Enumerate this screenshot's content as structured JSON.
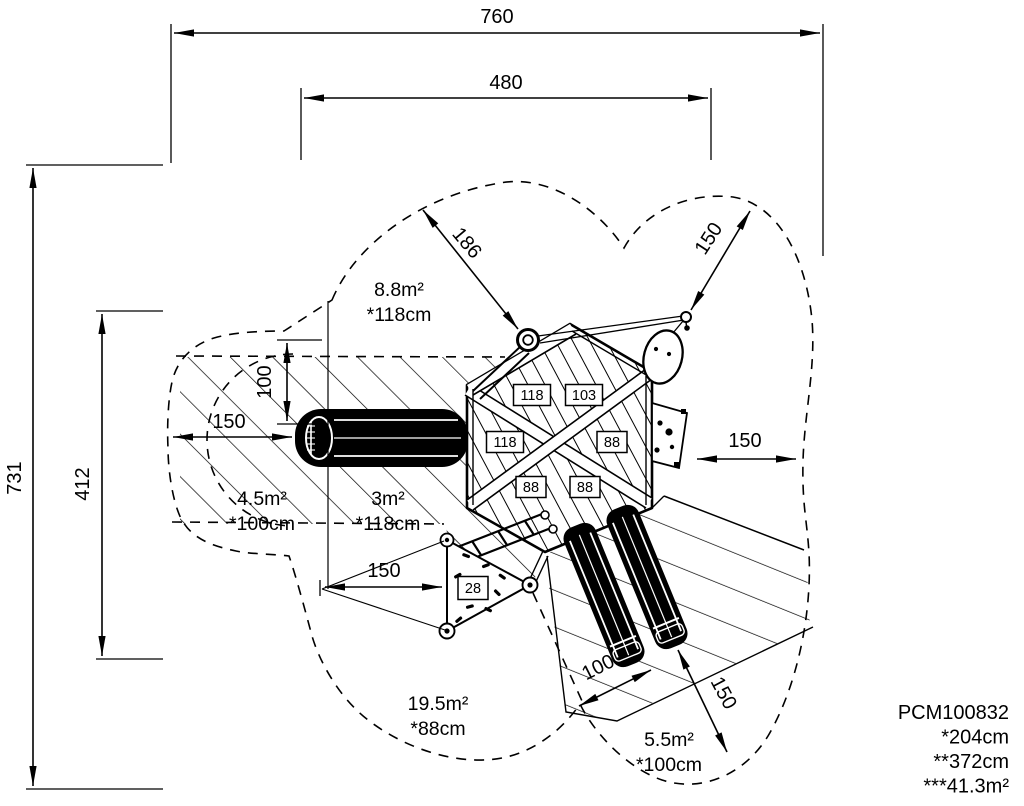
{
  "meta": {
    "ink": "#000000",
    "paper": "#ffffff"
  },
  "dimensions": [
    {
      "name": "dim-760",
      "label": "760",
      "x": 497,
      "y": 23,
      "rot": 0
    },
    {
      "name": "dim-480",
      "label": "480",
      "x": 506,
      "y": 89,
      "rot": 0
    },
    {
      "name": "dim-731",
      "label": "731",
      "x": 21,
      "y": 478,
      "rot": -90
    },
    {
      "name": "dim-412",
      "label": "412",
      "x": 89,
      "y": 484,
      "rot": -90
    },
    {
      "name": "dim-186",
      "label": "186",
      "x": 462,
      "y": 247,
      "rot": 50
    },
    {
      "name": "dim-150-top-right",
      "label": "150",
      "x": 714,
      "y": 242,
      "rot": -57
    },
    {
      "name": "dim-100-left",
      "label": "100",
      "x": 271,
      "y": 382,
      "rot": -90
    },
    {
      "name": "dim-150-left",
      "label": "150",
      "x": 229,
      "y": 428,
      "rot": 0
    },
    {
      "name": "dim-150-right",
      "label": "150",
      "x": 745,
      "y": 447,
      "rot": 0
    },
    {
      "name": "dim-150-bottom",
      "label": "150",
      "x": 384,
      "y": 577,
      "rot": 0
    },
    {
      "name": "dim-100-slide",
      "label": "100",
      "x": 601,
      "y": 673,
      "rot": -27
    },
    {
      "name": "dim-150-slide",
      "label": "150",
      "x": 718,
      "y": 696,
      "rot": 62
    }
  ],
  "zones": [
    {
      "name": "zone-swing",
      "area": "8.8m²",
      "height_note": "*118cm",
      "x": 399,
      "y": 296
    },
    {
      "name": "zone-slide-left",
      "area": "4.5m²",
      "height_note": "*100cm",
      "x": 262,
      "y": 505
    },
    {
      "name": "zone-tower",
      "area": "3m²",
      "height_note": "*118cm",
      "x": 388,
      "y": 505
    },
    {
      "name": "zone-lower-left",
      "area": "19.5m²",
      "height_note": "*88cm",
      "x": 438,
      "y": 710
    },
    {
      "name": "zone-slide-right",
      "area": "5.5m²",
      "height_note": "*100cm",
      "x": 669,
      "y": 746
    }
  ],
  "deck_labels": [
    {
      "name": "deck-label-118-a",
      "text": "118",
      "cx": 532,
      "cy": 395,
      "w": 37,
      "h": 21
    },
    {
      "name": "deck-label-103",
      "text": "103",
      "cx": 584,
      "cy": 395,
      "w": 37,
      "h": 21
    },
    {
      "name": "deck-label-118-b",
      "text": "118",
      "cx": 505,
      "cy": 442,
      "w": 37,
      "h": 21
    },
    {
      "name": "deck-label-88-a",
      "text": "88",
      "cx": 612,
      "cy": 442,
      "w": 30,
      "h": 21
    },
    {
      "name": "deck-label-88-b",
      "text": "88",
      "cx": 531,
      "cy": 487,
      "w": 30,
      "h": 21
    },
    {
      "name": "deck-label-88-c",
      "text": "88",
      "cx": 585,
      "cy": 487,
      "w": 30,
      "h": 21
    },
    {
      "name": "deck-label-28",
      "text": "28",
      "cx": 473,
      "cy": 588,
      "w": 30,
      "h": 23
    }
  ],
  "part_block": {
    "part_number": "PCM100832",
    "note1": "*204cm",
    "note2": "**372cm",
    "note3": "***41.3m²",
    "x": 1009,
    "y": 719,
    "line_height": 24.5
  }
}
